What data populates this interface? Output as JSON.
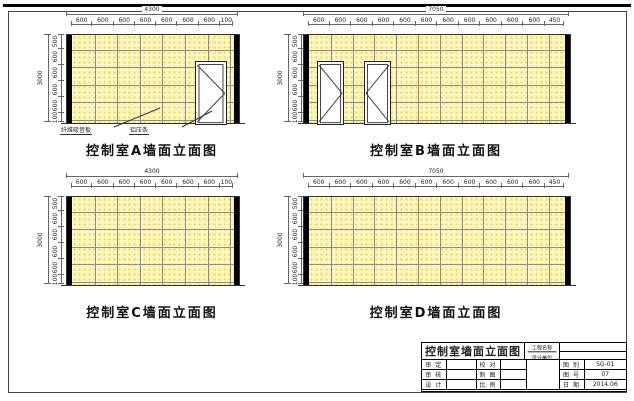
{
  "colors": {
    "panel_fill": "#fcf8d8",
    "panel_speckle": "#f0dd3c",
    "grid_line": "#8d8d8d",
    "column_black": "#000000",
    "dim_line": "#666666"
  },
  "elevations": [
    {
      "id": "A",
      "caption": "控制室A墙面立面图",
      "width_total": "4300",
      "width_segments": [
        "600",
        "600",
        "600",
        "600",
        "600",
        "600",
        "600",
        "100"
      ],
      "height_total": "3000",
      "height_segments": [
        "500",
        "600",
        "600",
        "600",
        "600",
        "100"
      ],
      "doors": [
        {
          "x": 0.76,
          "w": 0.185,
          "hinge": "right"
        }
      ],
      "annotations": [
        {
          "text": "纤维吸音板"
        },
        {
          "text": "铝压条"
        }
      ]
    },
    {
      "id": "B",
      "caption": "控制室B墙面立面图",
      "width_total": "7050",
      "width_segments": [
        "600",
        "600",
        "600",
        "600",
        "600",
        "600",
        "600",
        "600",
        "600",
        "600",
        "600",
        "450"
      ],
      "height_total": "3000",
      "height_segments": [
        "500",
        "600",
        "600",
        "600",
        "600",
        "100"
      ],
      "doors": [
        {
          "x": 0.031,
          "w": 0.098,
          "hinge": "right"
        },
        {
          "x": 0.215,
          "w": 0.098,
          "hinge": "left"
        }
      ],
      "annotations": []
    },
    {
      "id": "C",
      "caption": "控制室C墙面立面图",
      "width_total": "4300",
      "width_segments": [
        "600",
        "600",
        "600",
        "600",
        "600",
        "600",
        "600",
        "100"
      ],
      "height_total": "3000",
      "height_segments": [
        "500",
        "600",
        "600",
        "600",
        "600",
        "100"
      ],
      "doors": [],
      "annotations": []
    },
    {
      "id": "D",
      "caption": "控制室D墙面立面图",
      "width_total": "7050",
      "width_segments": [
        "600",
        "600",
        "600",
        "600",
        "600",
        "600",
        "600",
        "600",
        "600",
        "600",
        "600",
        "450"
      ],
      "height_total": "3000",
      "height_segments": [
        "500",
        "600",
        "600",
        "600",
        "600",
        "100"
      ],
      "doors": [],
      "annotations": []
    }
  ],
  "title_block": {
    "title": "控制室墙面立面图",
    "project_label": "工程名称",
    "design_label": "设计单位",
    "project_value": "",
    "design_value": "",
    "rows": [
      {
        "l1": "审 定",
        "v1": "",
        "l2": "校 对",
        "v2": "",
        "l3": "图 别",
        "v3": "SG-01"
      },
      {
        "l1": "审 核",
        "v1": "",
        "l2": "制 图",
        "v2": "",
        "l3": "图 号",
        "v3": "07"
      },
      {
        "l1": "设 计",
        "v1": "",
        "l2": "比 例",
        "v2": "",
        "l3": "日 期",
        "v3": "2014.06"
      }
    ]
  }
}
